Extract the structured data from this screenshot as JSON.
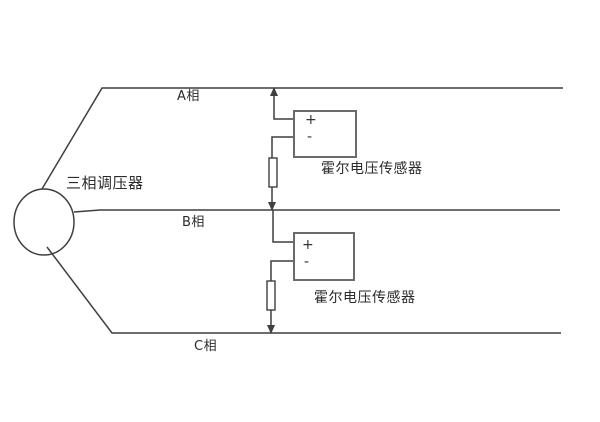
{
  "diagram": {
    "regulator_label": "三相调压器",
    "phase_a_label": "A相",
    "phase_b_label": "B相",
    "phase_c_label": "C相",
    "sensor1": {
      "label": "霍尔电压传感器",
      "plus": "+",
      "minus": "-"
    },
    "sensor2": {
      "label": "霍尔电压传感器",
      "plus": "+",
      "minus": "-"
    }
  },
  "colors": {
    "background": "#ffffff",
    "line": "#3f3f3f",
    "box-border": "#6b6b6b",
    "text": "#2b2b2b"
  }
}
